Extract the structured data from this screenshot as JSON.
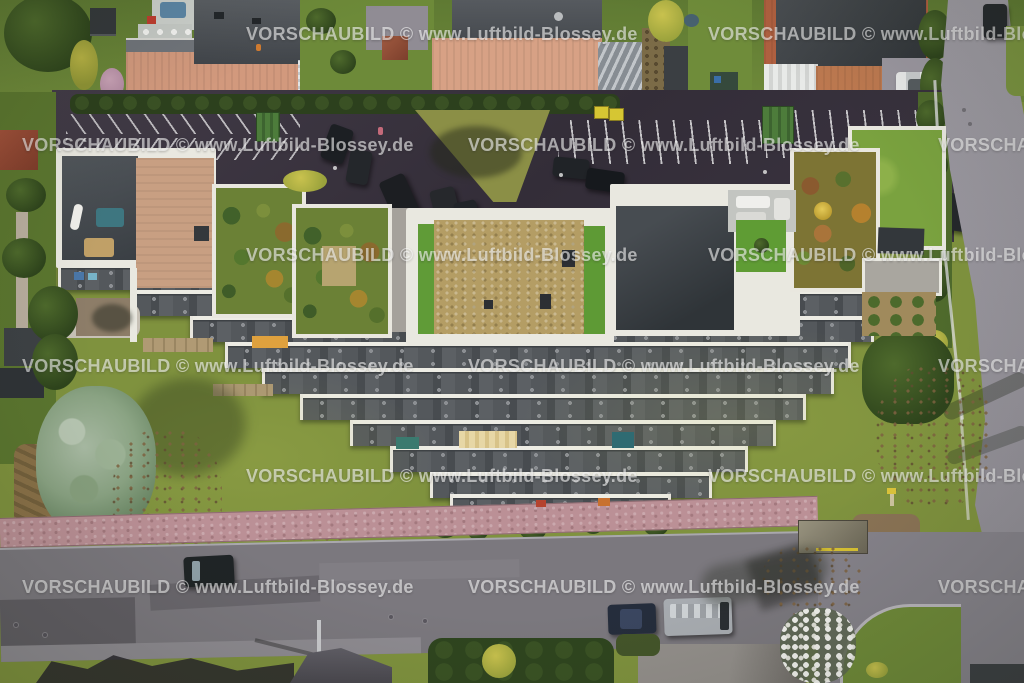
{
  "watermark": {
    "text": "VORSCHAUBILD © www.Luftbild-Blossey.de",
    "color": "#ffffff",
    "opacity": 0.58,
    "font_weight": "bold",
    "tile_rows_y": [
      24,
      135,
      245,
      356,
      466,
      577
    ],
    "tile_cols_x_odd_rows": [
      246,
      708
    ],
    "tile_cols_x_even_rows": [
      22,
      468,
      938
    ]
  },
  "scene": {
    "type": "aerial-photograph",
    "features": [
      "terraced-apartment-complex-with-stepped-balcony-rows",
      "rooftop-gardens-and-terraces",
      "gravel-flat-roof",
      "parking-lot-with-marked-stalls",
      "suburban-houses-with-tiled-and-slate-roofs",
      "large-lawns-with-trees",
      "residential-street-with-parked-cars",
      "curved-side-road-junction",
      "bus-shelter",
      "pink-gravel-footpath",
      "magnolia-tree-in-bloom",
      "silver-conifer-tree"
    ],
    "vehicles": {
      "parking_lot_cars": 10,
      "street_parked_vehicles": 4,
      "white_car_on_driveway": 1,
      "car_on_side_road": 1,
      "notable_colors": [
        "black",
        "dark-blue",
        "white",
        "silver"
      ]
    },
    "containers": {
      "green_dumpsters": 2,
      "yellow_containers": 2
    }
  },
  "palette": {
    "lawn": "#7f923e",
    "lawn_light": "#9aa94c",
    "parking_asphalt": "#3a333f",
    "street_asphalt": "#7b787e",
    "side_road": "#9c99a1",
    "path_pink": "#bb9096",
    "parapet_white": "#e9e8e0",
    "roof_slate": "#43484c",
    "roof_salmon": "#d2997d",
    "roof_brick": "#b06040",
    "roof_gravel_tan": "#b49d64",
    "turf_green": "#5f9c34",
    "hedge_dark": "#2e441c",
    "conifer_silver": "#8aa383",
    "dumpster_green": "#4d7c3b",
    "container_yellow": "#d6c633",
    "awning_cream": "#e7d7a6",
    "awning_orange": "#dfa13e",
    "car_dark": "#23262a",
    "car_white": "#e9eaea",
    "van_silver": "#a8acb1",
    "blossom_white": "#f2f2ee"
  }
}
